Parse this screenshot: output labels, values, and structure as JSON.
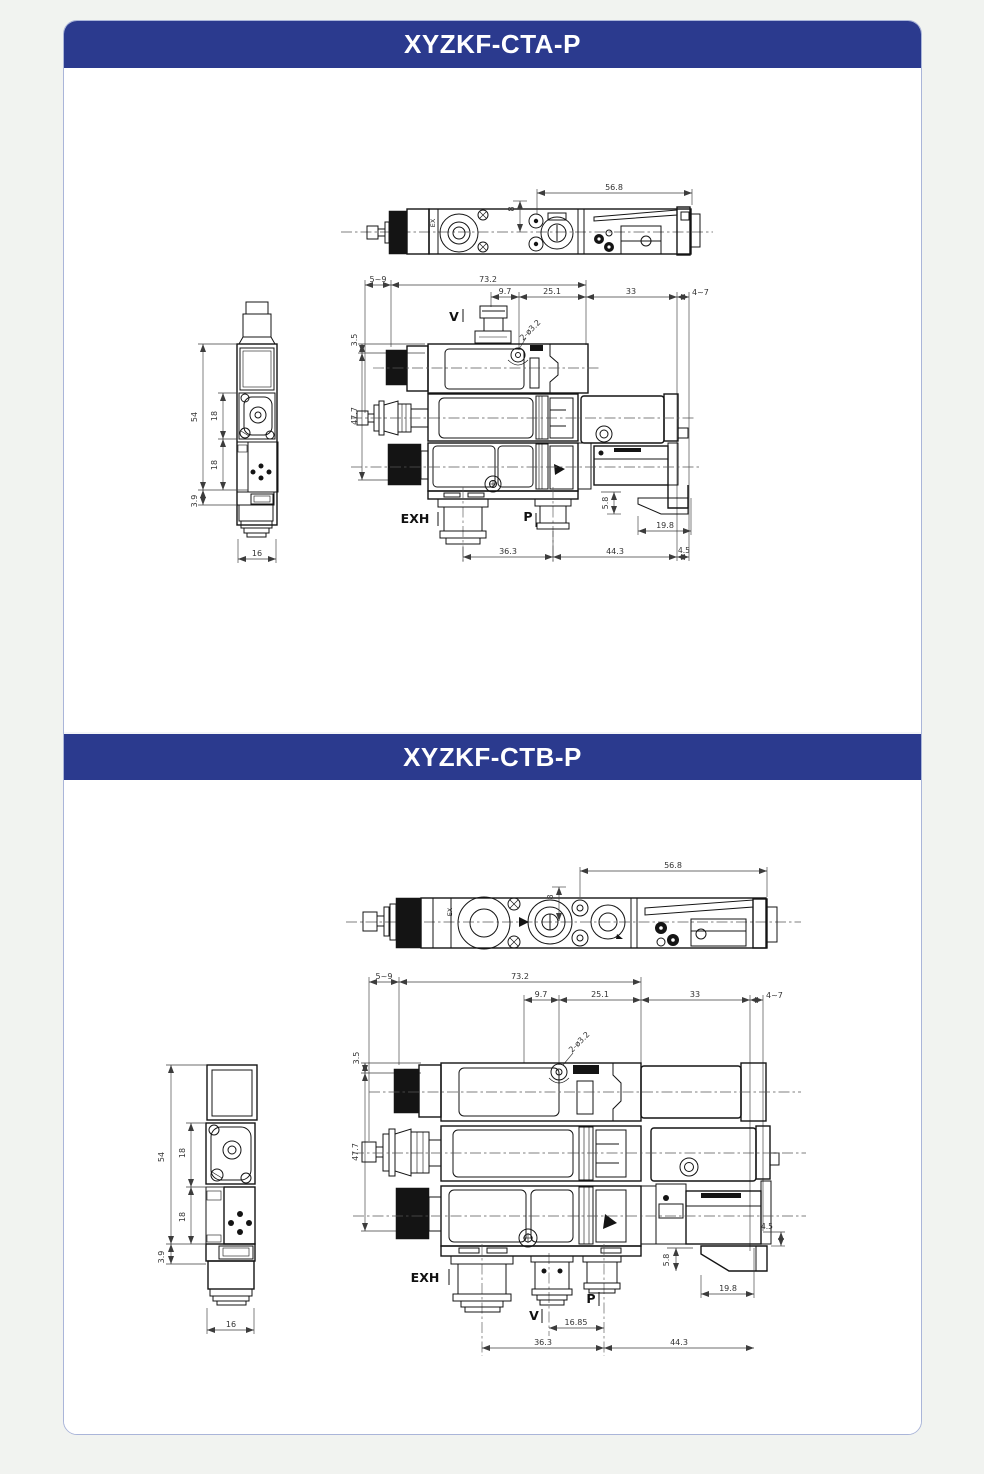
{
  "panel_a": {
    "title": "XYZKF-CTA-P",
    "top_view": {
      "width": "56.8",
      "offset": "8",
      "marking": "EX"
    },
    "front_view": {
      "mount_depth": "5~9",
      "body_width": "73.2",
      "spacing_a": "9.7",
      "spacing_b": "25.1",
      "spacing_c": "33",
      "spacing_d": "4~7",
      "top_offset": "3.5",
      "height": "47.7",
      "holes_note": "2-ø3.2",
      "port_v": "V",
      "port_exh": "EXH",
      "port_p": "P",
      "bottom_a": "36.3",
      "bottom_b": "44.3",
      "bottom_c": "4.5",
      "foot_height": "5.8",
      "foot_width": "19.8"
    },
    "side_view": {
      "height_total": "54",
      "pitch_upper": "18",
      "pitch_lower": "18",
      "foot": "3.9",
      "width": "16"
    }
  },
  "panel_b": {
    "title": "XYZKF-CTB-P",
    "top_view": {
      "width": "56.8",
      "offset": "8",
      "marking": "EX"
    },
    "front_view": {
      "mount_depth": "5~9",
      "body_width": "73.2",
      "spacing_a": "9.7",
      "spacing_b": "25.1",
      "spacing_c": "33",
      "spacing_d": "4~7",
      "top_offset": "3.5",
      "height": "47.7",
      "holes_note": "2-ø3.2",
      "port_exh": "EXH",
      "port_v": "V",
      "port_p": "P",
      "port_spacing": "16.85",
      "bottom_a": "36.3",
      "bottom_b": "44.3",
      "foot_height": "5.8",
      "foot_width": "19.8",
      "step": "4.5"
    },
    "side_view": {
      "height_total": "54",
      "pitch_upper": "18",
      "pitch_lower": "18",
      "foot": "3.9",
      "width": "16"
    }
  }
}
